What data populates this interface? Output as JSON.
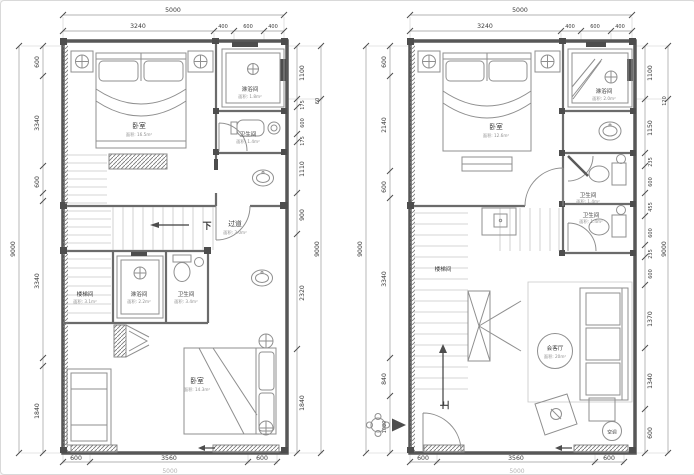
{
  "plans": [
    {
      "id": "upper-floor-plan",
      "dims": {
        "top_total": "5000",
        "top": [
          "3240",
          "400",
          "600",
          "400"
        ],
        "left_total": "9000",
        "left": [
          "600",
          "3340",
          "600",
          "3340",
          "1840"
        ],
        "right": [
          "1100",
          "175",
          "600",
          "175",
          "1110",
          "900",
          "2320",
          "1840"
        ],
        "right_offset": "60",
        "right_total": "9000",
        "bottom": [
          "600",
          "3560",
          "600"
        ],
        "bottom_total": "5000"
      },
      "rooms": {
        "bedroom_top": {
          "label": "卧室",
          "area": "面积: 16.5m²"
        },
        "shower_top": {
          "label": "淋浴间",
          "area": "面积: 1.8m²"
        },
        "toilet_top": {
          "label": "卫生间",
          "area": "面积: 1.4m²"
        },
        "corridor": {
          "label": "过道",
          "area": "面积: 3.0m²"
        },
        "stairwell": {
          "label": "楼梯间",
          "area": "面积: 3.1m²"
        },
        "shower_mid": {
          "label": "淋浴间",
          "area": "面积: 2.2m²"
        },
        "toilet_mid": {
          "label": "卫生间",
          "area": "面积: 3.4m²"
        },
        "bedroom_bottom": {
          "label": "卧室",
          "area": "面积: 14.3m²"
        }
      },
      "annotations": {
        "down_label": "下"
      }
    },
    {
      "id": "lower-floor-plan",
      "dims": {
        "top_total": "5000",
        "top": [
          "3240",
          "400",
          "600",
          "400"
        ],
        "left_total": "9000",
        "left": [
          "600",
          "2140",
          "600",
          "3340",
          "840",
          "1080"
        ],
        "right": [
          "1100",
          "1150",
          "235",
          "600",
          "455",
          "600",
          "235",
          "600",
          "1370",
          "1340",
          "600"
        ],
        "right_offset": "120",
        "right_total": "9000",
        "bottom": [
          "600",
          "3560",
          "600"
        ],
        "bottom_total": "5000"
      },
      "rooms": {
        "bedroom": {
          "label": "卧室",
          "area": "面积: 12.6m²"
        },
        "shower": {
          "label": "淋浴间",
          "area": "面积: 2.0m²"
        },
        "toilet_1": {
          "label": "卫生间",
          "area": "面积: 1.4m²"
        },
        "toilet_2": {
          "label": "卫生间",
          "area": "面积: 1.4m²"
        },
        "stairwell": {
          "label": "楼梯间"
        },
        "living": {
          "label": "会客厅",
          "area": "面积: 20m²"
        },
        "ac": {
          "label": "空调"
        }
      },
      "annotations": {
        "up_label": "上"
      }
    }
  ]
}
